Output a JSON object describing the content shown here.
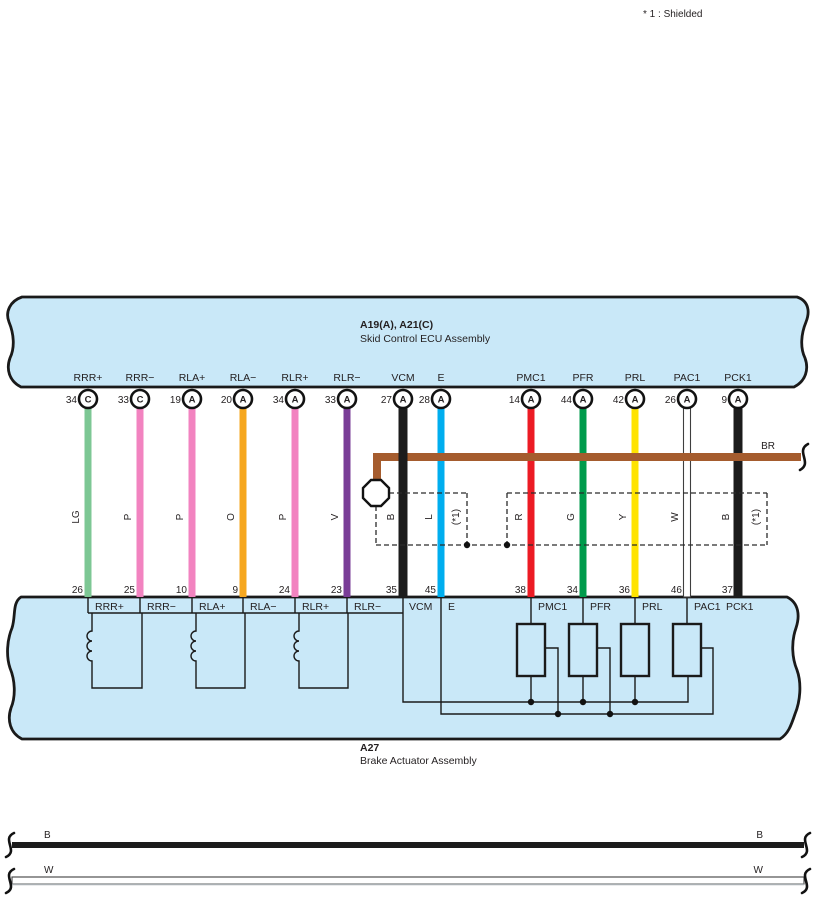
{
  "note": "* 1 : Shielded",
  "ecu_band": {
    "code": "A19(A), A21(C)",
    "name": "Skid Control ECU Assembly"
  },
  "actuator_band": {
    "code": "A27",
    "name": "Brake Actuator Assembly"
  },
  "shield_ref": "(*1)",
  "br_wire_label": "BR",
  "bus_wires": {
    "black_label": "B",
    "white_label": "W"
  },
  "colors": {
    "LG": "#7dc794",
    "P": "#f283c0",
    "O": "#f6a71f",
    "V": "#7a3d97",
    "B": "#1c1c1c",
    "L": "#00aeef",
    "R": "#ec1b24",
    "G": "#009b4c",
    "Y": "#ffe300",
    "W": "#ffffff",
    "BR": "#a55c2e",
    "band_fill": "#c9e8f8"
  },
  "wires": [
    {
      "signal": "RRR+",
      "pin_ecu": "34",
      "conn": "C",
      "color": "LG",
      "hex": "#7dc794",
      "pin_act": "26"
    },
    {
      "signal": "RRR−",
      "pin_ecu": "33",
      "conn": "C",
      "color": "P",
      "hex": "#f283c0",
      "pin_act": "25"
    },
    {
      "signal": "RLA+",
      "pin_ecu": "19",
      "conn": "A",
      "color": "P",
      "hex": "#f283c0",
      "pin_act": "10"
    },
    {
      "signal": "RLA−",
      "pin_ecu": "20",
      "conn": "A",
      "color": "O",
      "hex": "#f6a71f",
      "pin_act": "9"
    },
    {
      "signal": "RLR+",
      "pin_ecu": "34",
      "conn": "A",
      "color": "P",
      "hex": "#f283c0",
      "pin_act": "24"
    },
    {
      "signal": "RLR−",
      "pin_ecu": "33",
      "conn": "A",
      "color": "V",
      "hex": "#7a3d97",
      "pin_act": "23"
    },
    {
      "signal": "VCM",
      "pin_ecu": "27",
      "conn": "A",
      "color": "B",
      "hex": "#1c1c1c",
      "pin_act": "35"
    },
    {
      "signal": "E",
      "pin_ecu": "28",
      "conn": "A",
      "color": "L",
      "hex": "#00aeef",
      "pin_act": "45"
    },
    {
      "signal": "PMC1",
      "pin_ecu": "14",
      "conn": "A",
      "color": "R",
      "hex": "#ec1b24",
      "pin_act": "38"
    },
    {
      "signal": "PFR",
      "pin_ecu": "44",
      "conn": "A",
      "color": "G",
      "hex": "#009b4c",
      "pin_act": "34"
    },
    {
      "signal": "PRL",
      "pin_ecu": "42",
      "conn": "A",
      "color": "Y",
      "hex": "#ffe300",
      "pin_act": "36"
    },
    {
      "signal": "PAC1",
      "pin_ecu": "26",
      "conn": "A",
      "color": "W",
      "hex": "#ffffff",
      "pin_act": "46"
    },
    {
      "signal": "PCK1",
      "pin_ecu": "9",
      "conn": "A",
      "color": "B",
      "hex": "#1c1c1c",
      "pin_act": "37"
    }
  ]
}
